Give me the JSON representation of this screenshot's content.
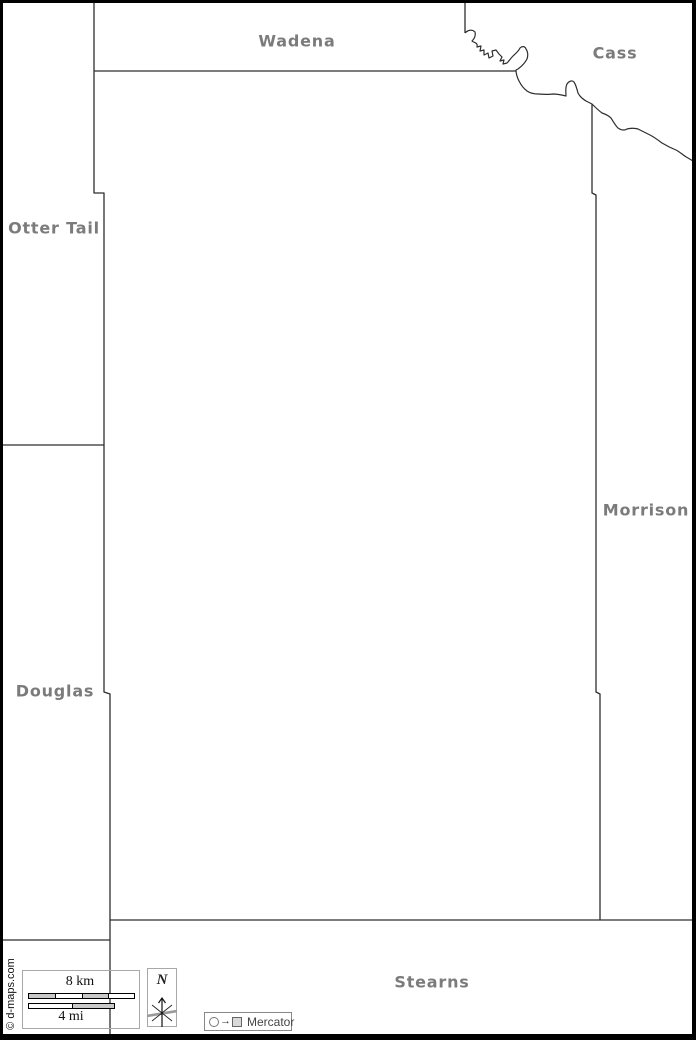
{
  "map": {
    "type": "county-outline-map",
    "labeled_county_names": [
      "Wadena",
      "Cass",
      "Otter Tail",
      "Morrison",
      "Douglas",
      "Stearns"
    ],
    "counties": [
      {
        "name": "Wadena"
      },
      {
        "name": "Cass"
      },
      {
        "name": "Otter Tail"
      },
      {
        "name": "Morrison"
      },
      {
        "name": "Douglas"
      },
      {
        "name": "Stearns"
      }
    ]
  },
  "scale_bar": {
    "km_label": "8 km",
    "mi_label": "4 mi"
  },
  "north": {
    "label": "N"
  },
  "projection": {
    "label": "Mercator",
    "arrow_glyph": "→"
  },
  "credit": {
    "text": "© d-maps.com"
  },
  "colors": {
    "background": "#ffffff",
    "frame": "#000000",
    "boundary_line": "#2e2e2e",
    "label_gray": "#7b7b7b",
    "scale_segment_gray": "#c9c9c9",
    "box_border_gray": "#a8a8a8"
  }
}
